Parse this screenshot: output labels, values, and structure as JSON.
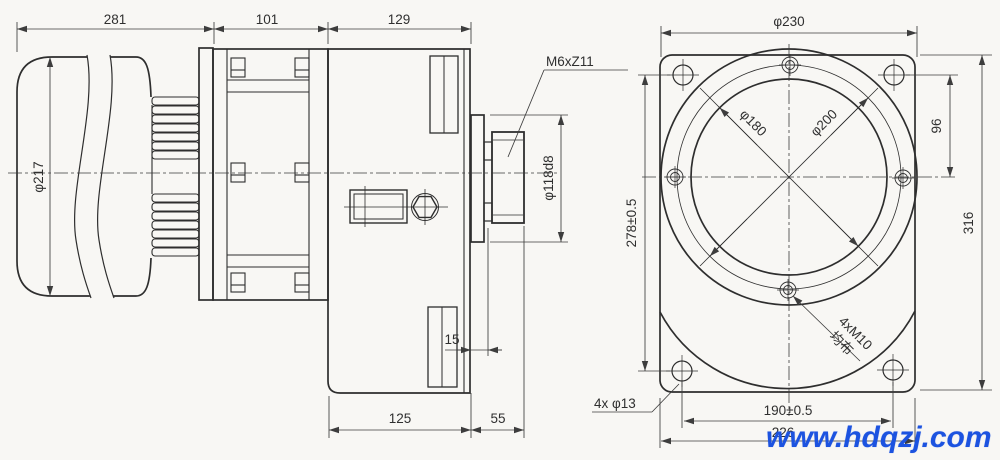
{
  "side": {
    "dim_motor_len": "281",
    "dim_coupling_len": "101",
    "dim_gearbox_len": "129",
    "dim_motor_dia": "φ217",
    "spline_label": "M6xZ11",
    "dim_boss_dia": "φ118d8",
    "dim_spigot_len": "15",
    "dim_base_len": "125",
    "dim_shaft_len": "55"
  },
  "front": {
    "dim_flange_dia": "φ230",
    "dim_bore_dia": "φ180",
    "dim_bolt_circle_dia": "φ200",
    "dim_hole_offset": "96",
    "dim_hole_pitch_vertical": "278±0.5",
    "dim_overall_height": "316",
    "dim_hole_pitch_horizontal": "190±0.5",
    "dim_overall_width": "226",
    "tapped_holes": "4xM10",
    "tapped_holes_note": "均布",
    "corner_holes": "4x φ13"
  },
  "watermark": {
    "text": "www.hdqzj.com",
    "color": "#1c53e0"
  },
  "colors": {
    "line": "#2e2e2e",
    "dim": "#3d3d3d",
    "background": "#f8f7f4"
  }
}
